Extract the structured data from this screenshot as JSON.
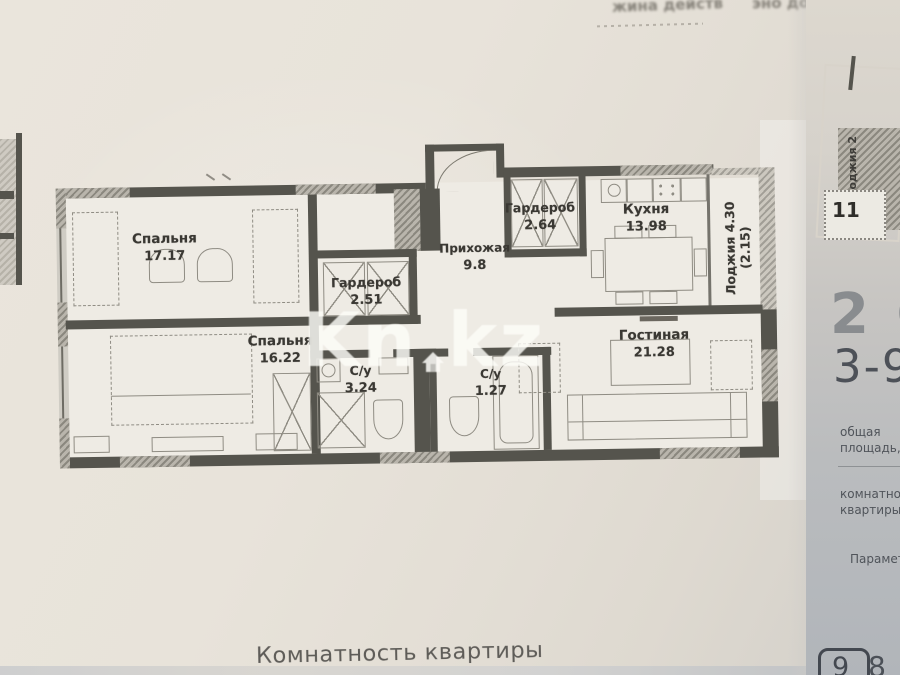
{
  "photo": {
    "watermark_part1": "Kn",
    "watermark_part2": "kz",
    "caption": "Комнатность квартиры",
    "artifact_center": "жина действ",
    "artifact_right": "эно до"
  },
  "plan": {
    "rooms": [
      {
        "name": "Спальня",
        "area": "17.17"
      },
      {
        "name": "Гардероб",
        "area": "2.51"
      },
      {
        "name": "Спальня",
        "area": "16.22"
      },
      {
        "name": "С/у",
        "area": "3.24"
      },
      {
        "name": "Прихожая",
        "area": "9.8"
      },
      {
        "name": "Гардероб",
        "area": "2.64"
      },
      {
        "name": "Кухня",
        "area": "13.98"
      },
      {
        "name": "Лоджия",
        "area": "4.30",
        "area_alt": "(2.15)"
      },
      {
        "name": "Гостиная",
        "area": "21.28"
      },
      {
        "name": "С/у",
        "area": "1.27"
      }
    ]
  },
  "side_panel": {
    "mini_plan_loggia": "Лоджия 2",
    "mini_plan_room": "11",
    "headline": "2 С",
    "subheadline": "3-9",
    "field1_line1": "общая",
    "field1_line2": "площадь, м",
    "field2_line1": "комнатность",
    "field2_line2": "квартиры",
    "field3": "Параметр",
    "badge": "9",
    "value": "8 7"
  }
}
